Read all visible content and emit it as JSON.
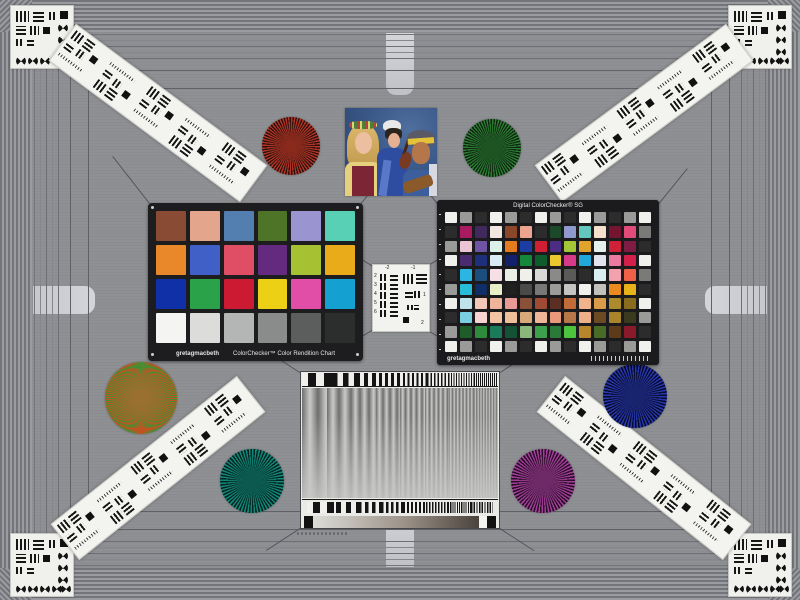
{
  "scene": {
    "type": "camera-test-chart-scene",
    "field_color": "#8e9094"
  },
  "frame": {
    "stripe_dark": "#73757a",
    "stripe_light": "#9a9ca1",
    "line_color": "#5f6166",
    "tab_color": "#cbcdd2"
  },
  "colorchecker24": {
    "brand": "gretagmacbeth",
    "title": "ColorChecker™ Color Rendition Chart",
    "rows": 4,
    "cols": 6,
    "patches": [
      "#8a4b35",
      "#e3a58b",
      "#527eb0",
      "#4e7428",
      "#9a94d0",
      "#58d0b6",
      "#e8882a",
      "#4060c8",
      "#e04e66",
      "#642a80",
      "#a6c232",
      "#eaab1a",
      "#1030a8",
      "#2aa24a",
      "#cc1a32",
      "#ecd016",
      "#e04ea8",
      "#14a0d0",
      "#f4f4f2",
      "#dcdcda",
      "#b4b6b6",
      "#8a8c8c",
      "#5c5e5e",
      "#2c2e2e"
    ]
  },
  "colorchecker_sg": {
    "title": "Digital ColorChecker® SG",
    "brand": "gretagmacbeth",
    "rows": 10,
    "cols": 14,
    "patches": [
      [
        "#f0f0ec",
        "#9a9a98",
        "#2c2c2c",
        "#f0f0ec",
        "#9a9a98",
        "#2c2c2c",
        "#f0f0ec",
        "#9a9a98",
        "#2c2c2c",
        "#f0f0ec",
        "#9a9a98",
        "#2c2c2c",
        "#9a9a98",
        "#f0f0ec"
      ],
      [
        "#2c2c2c",
        "#aa1a60",
        "#41295e",
        "#f2e6e0",
        "#8c4629",
        "#eda48e",
        "#2c2c2c",
        "#1c4a28",
        "#8f99ce",
        "#63c7be",
        "#f5e0cb",
        "#731430",
        "#e24a7a",
        "#7a7a78"
      ],
      [
        "#9a9a98",
        "#ecc5d4",
        "#6f53a5",
        "#dcf0ea",
        "#e57b1f",
        "#1c3ea4",
        "#d01f34",
        "#4b2d84",
        "#a3c538",
        "#e0a32b",
        "#e6f0ed",
        "#cf2239",
        "#7e1c44",
        "#2c2c2c"
      ],
      [
        "#f0f0ec",
        "#4a2a71",
        "#1e2f7c",
        "#d9ecf5",
        "#12206b",
        "#15883d",
        "#0e5c2e",
        "#ecc82f",
        "#d63a89",
        "#22a8d8",
        "#e3e3f0",
        "#ea7aa0",
        "#d2204a",
        "#f0f0ec"
      ],
      [
        "#2c2c2c",
        "#2bb5e2",
        "#1c4e7d",
        "#f6dfe5",
        "#e9efe6",
        "#f0efe9",
        "#d8d8d4",
        "#8a8a88",
        "#5a5a58",
        "#2c2c2c",
        "#d9eef0",
        "#f3a1af",
        "#ef6149",
        "#7a7a78"
      ],
      [
        "#9a9a98",
        "#27bcd8",
        "#0f2d66",
        "#e9f0c8",
        "#20201e",
        "#4a4a48",
        "#787876",
        "#9c9c9a",
        "#c4c4c2",
        "#f0f0ec",
        "#c0c0bc",
        "#ea8a1f",
        "#e7b319",
        "#2c2c2c"
      ],
      [
        "#f0f0ec",
        "#bfe3ea",
        "#f3c7b6",
        "#f0b49a",
        "#e89a96",
        "#8a5138",
        "#a04a33",
        "#5b3023",
        "#c26a38",
        "#f0b48c",
        "#d99a4a",
        "#ac8b2d",
        "#8a6c1e",
        "#f0f0ec"
      ],
      [
        "#2c2c2c",
        "#7ccfe0",
        "#f6d4d2",
        "#f3c3a2",
        "#eec09a",
        "#d9a878",
        "#f0b698",
        "#e99a7a",
        "#b67848",
        "#edb088",
        "#6b4a24",
        "#a8852a",
        "#3a3a1e",
        "#9a9a98"
      ],
      [
        "#9a9a98",
        "#1e5c2a",
        "#2e8b3c",
        "#1a7a5a",
        "#145236",
        "#8ab87a",
        "#3da04a",
        "#2c7a3a",
        "#4cc43e",
        "#b8862a",
        "#486c28",
        "#5c3a1a",
        "#8a1a2a",
        "#2c2c2c"
      ],
      [
        "#f0f0ec",
        "#9a9a98",
        "#2c2c2c",
        "#f0f0ec",
        "#9a9a98",
        "#2c2c2c",
        "#f0f0ec",
        "#9a9a98",
        "#2c2c2c",
        "#f0f0ec",
        "#9a9a98",
        "#2c2c2c",
        "#9a9a98",
        "#f0f0ec"
      ]
    ]
  },
  "usaf_target": {
    "numbers_top": [
      "-2",
      "-1"
    ],
    "numbers_left": [
      "2",
      "3",
      "4",
      "5",
      "6"
    ],
    "numbers_right": [
      "1",
      "2"
    ]
  },
  "siemens_stars": [
    {
      "name": "red-star",
      "a": "#b23527",
      "b": "#2c100c",
      "center": "#8a2a1c",
      "seg": 3,
      "d": 58,
      "x": 262,
      "y": 117
    },
    {
      "name": "green-star",
      "a": "#2e7d33",
      "b": "#0c2410",
      "center": "#1d5422",
      "seg": 3,
      "d": 58,
      "x": 463,
      "y": 119
    },
    {
      "name": "red-green-star",
      "a": "#c05522",
      "b": "#4a8a30",
      "center": "#9a7030",
      "seg": 1.8,
      "d": 72,
      "x": 105,
      "y": 362
    },
    {
      "name": "teal-star",
      "a": "#12877a",
      "b": "#04241f",
      "center": "#0b5a50",
      "seg": 3,
      "d": 64,
      "x": 220,
      "y": 449
    },
    {
      "name": "magenta-star",
      "a": "#a03f98",
      "b": "#2a0c26",
      "center": "#6e2a68",
      "seg": 3,
      "d": 64,
      "x": 511,
      "y": 449
    },
    {
      "name": "blue-star",
      "a": "#2838ac",
      "b": "#060a2c",
      "center": "#18246e",
      "seg": 3,
      "d": 64,
      "x": 603,
      "y": 364
    }
  ],
  "sweep_chart": {
    "bar_color": "#141414",
    "bar_background": "#f0efec",
    "gradient": [
      "#dcdcd8",
      "#9c9288",
      "#4a423c"
    ]
  }
}
